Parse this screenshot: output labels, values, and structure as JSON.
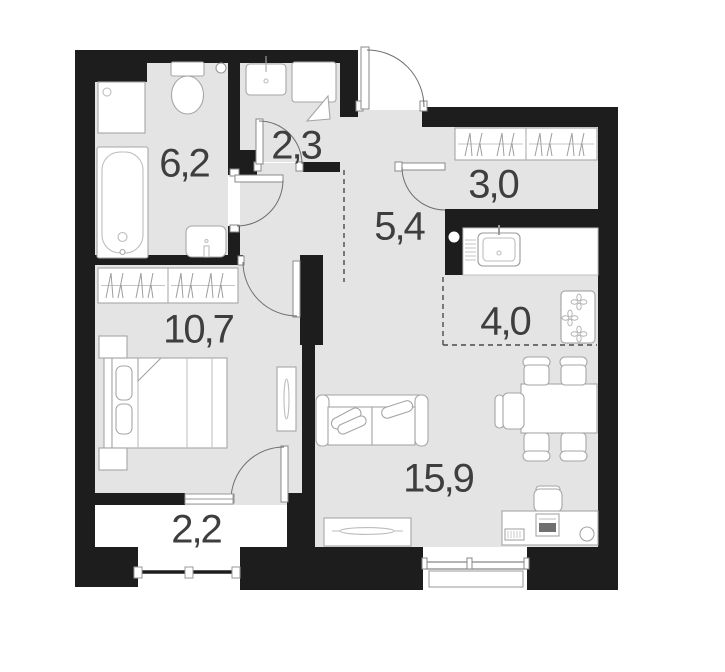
{
  "plan_title": "apartment-floor-plan",
  "colors": {
    "wall": "#1d1d1d",
    "floor": "#e4e4e4",
    "balcony_floor": "#ffffff",
    "furniture_fill": "#ffffff",
    "furniture_outline": "#a6a6a6",
    "door_arc": "#6e6e6e",
    "label": "#3e3e3e"
  },
  "rooms": [
    {
      "name": "bathroom",
      "area": "6,2",
      "fixtures": [
        "washing-machine-icon",
        "bathtub-icon",
        "toilet-icon",
        "sink-icon",
        "floor-drain-icon"
      ]
    },
    {
      "name": "shower-room",
      "area": "2,3",
      "fixtures": [
        "sink-icon",
        "shower-tray-icon"
      ]
    },
    {
      "name": "hallway",
      "area": "5,4",
      "fixtures": [
        "entrance-door-icon"
      ]
    },
    {
      "name": "wardrobe-room",
      "area": "3,0",
      "fixtures": [
        "closet-rail-icon"
      ]
    },
    {
      "name": "bedroom",
      "area": "10,7",
      "fixtures": [
        "closet-rail-icon",
        "double-bed-icon",
        "nightstand-icon",
        "mirror-icon",
        "balcony-door-icon"
      ]
    },
    {
      "name": "kitchen-zone",
      "area": "4,0",
      "fixtures": [
        "kitchen-counter-icon",
        "kitchen-sink-icon",
        "stove-icon"
      ]
    },
    {
      "name": "living-room",
      "area": "15,9",
      "fixtures": [
        "sofa-icon",
        "dining-table-icon",
        "chair-icon",
        "tv-stand-icon",
        "desk-icon",
        "stool-icon"
      ]
    },
    {
      "name": "balcony",
      "area": "2,2",
      "fixtures": [
        "window-icon"
      ]
    }
  ],
  "features": {
    "doors": 6,
    "windows": 3,
    "kitchen_zone_boundary": "dashed",
    "hall_zone_boundary": "dashed"
  }
}
